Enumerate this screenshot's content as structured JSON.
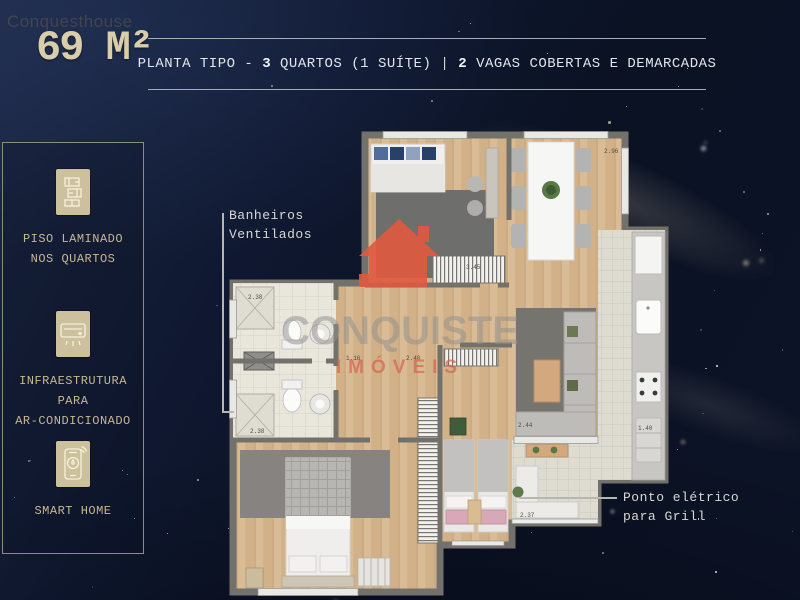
{
  "watermark": "Conquesthouse",
  "header": {
    "area": "69 M²",
    "title_prefix": "PLANTA TIPO - ",
    "bedrooms_count": "3",
    "bedrooms_label": " QUARTOS (1 SUÍTE)",
    "separator": "|",
    "parking_count": "2",
    "parking_label": " VAGAS COBERTAS E DEMARCADAS"
  },
  "sidebar": {
    "items": [
      {
        "icon": "laminate-floor-icon",
        "lines": [
          "PISO LAMINADO",
          "NOS QUARTOS"
        ]
      },
      {
        "icon": "air-conditioner-icon",
        "lines": [
          "INFRAESTRUTURA",
          "PARA",
          "AR-CONDICIONADO"
        ]
      },
      {
        "icon": "smart-home-icon",
        "lines": [
          "SMART HOME"
        ]
      }
    ]
  },
  "plan": {
    "watermark_brand": "CONQUISTE",
    "watermark_sub": "IMÓVEIS",
    "annotations": {
      "bathrooms_line1": "Banheiros",
      "bathrooms_line2": "Ventilados",
      "grill_line1": "Ponto elétrico",
      "grill_line2": "para Grill"
    },
    "dimensions": [
      {
        "t": "2.96"
      },
      {
        "t": "3.45"
      },
      {
        "t": "2.38"
      },
      {
        "t": "1.16"
      },
      {
        "t": "2.40"
      },
      {
        "t": "2.38"
      },
      {
        "t": "2.44"
      },
      {
        "t": "1.40"
      },
      {
        "t": "2.37"
      }
    ]
  },
  "colors": {
    "background": "#0e1628",
    "accent_cream": "#d9cdaa",
    "brand_red": "#e2593f",
    "wood_floor": "#d8ba93",
    "wall_gray": "#72716b"
  }
}
